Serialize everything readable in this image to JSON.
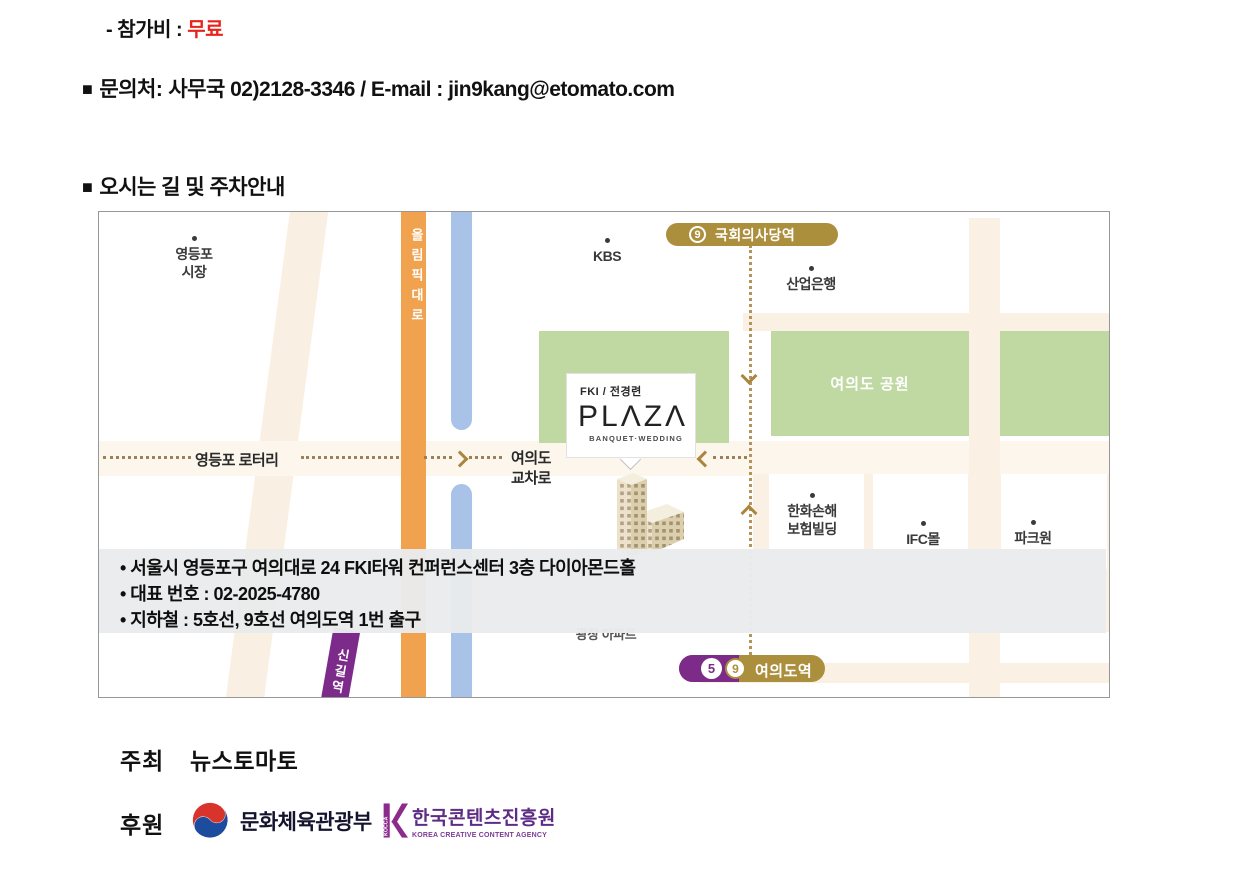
{
  "header": {
    "fee_prefix": "- 참가비 : ",
    "fee_value": "무료",
    "contact_marker": "■",
    "contact_label": "문의처:",
    "contact_detail": "사무국 02)2128-3346 / E-mail : jin9kang@etomato.com",
    "directions_marker": "■",
    "directions_title": "오시는 길 및 주차안내"
  },
  "map": {
    "olympic_road": "올림픽대로",
    "yeongdeungpo_market_1": "영등포",
    "yeongdeungpo_market_2": "시장",
    "kbs": "KBS",
    "industrial_bank": "산업은행",
    "yeouido_park": "여의도 공원",
    "yeongdeungpo_rotary": "영등포 로터리",
    "yeouido_intersection_1": "여의도",
    "yeouido_intersection_2": "교차로",
    "hanwha_1": "한화손해",
    "hanwha_2": "보험빌딩",
    "ifc_mall": "IFC몰",
    "park_one": "파크원",
    "gwangjang_apt": "광장 아파트",
    "singil_station": "신길역",
    "assembly_line": "9",
    "assembly_name": "국회의사당역",
    "yeouido_line5": "5",
    "yeouido_line9": "9",
    "yeouido_name": "여의도역",
    "venue_top": "FKI / 전경련",
    "venue_name": "PLΛZΛ",
    "venue_sub": "BANQUET·WEDDING",
    "info_line1": "• 서울시 영등포구 여의대로 24 FKI타워 컨퍼런스센터 3층 다이아몬드홀",
    "info_line2": "• 대표 번호 : 02-2025-4780",
    "info_line3": "• 지하철 : 5호선, 9호선 여의도역 1번 출구"
  },
  "footer": {
    "host_label": "주최",
    "host_name": "뉴스토마토",
    "sponsor_label": "후원",
    "mcst_name": "문화체육관광부",
    "kocca_k": "KOCCA",
    "kocca_name": "한국콘텐츠진흥원",
    "kocca_sub": "KOREA CREATIVE CONTENT AGENCY"
  },
  "colors": {
    "accent_red": "#e8231c",
    "road_orange": "#f0a24e",
    "river_blue": "#a9c3e8",
    "park_green": "#c0d9a3",
    "line9_gold": "#ac8f3d",
    "line5_purple": "#7c2b88",
    "kocca_purple": "#5e2c85"
  }
}
